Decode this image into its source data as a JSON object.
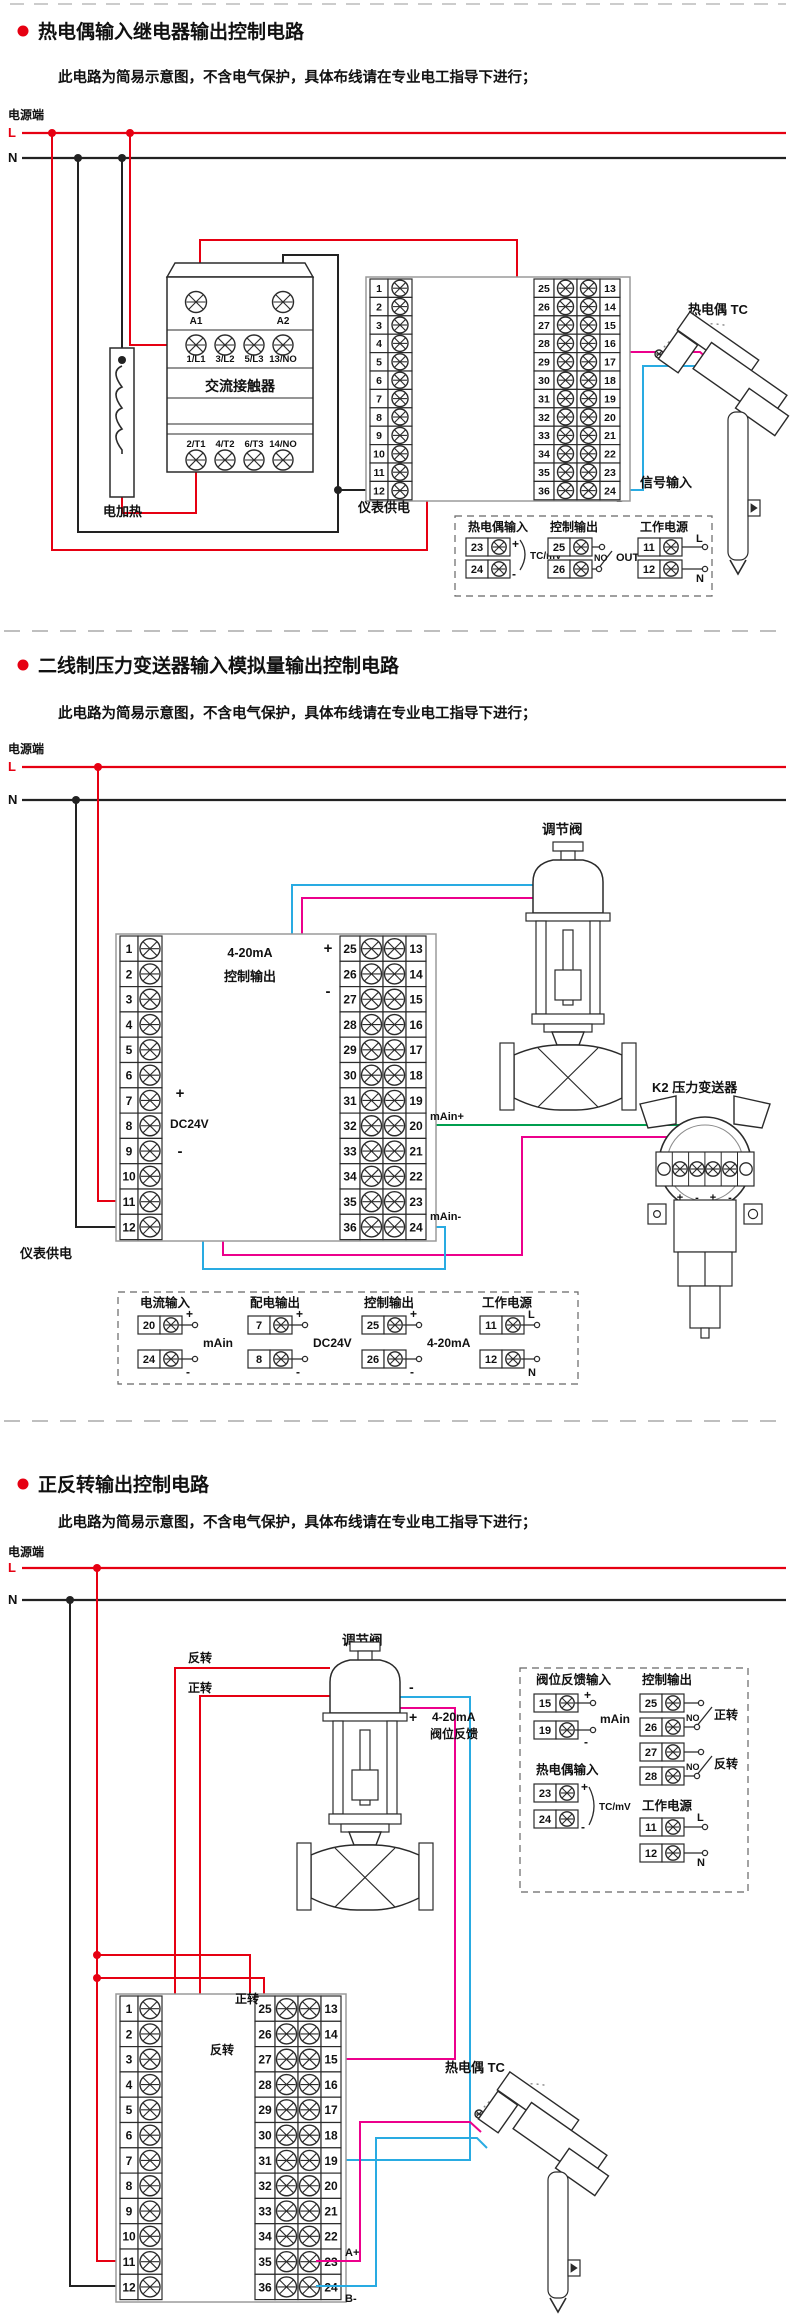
{
  "colors": {
    "red": "#e60012",
    "black": "#222222",
    "gray": "#9a9a9a",
    "pink": "#ec008c",
    "blue": "#29abe2",
    "green": "#009e4f"
  },
  "power": {
    "source": "电源端",
    "l": "L",
    "n": "N"
  },
  "terminals": {
    "left": [
      "1",
      "2",
      "3",
      "4",
      "5",
      "6",
      "7",
      "8",
      "9",
      "10",
      "11",
      "12"
    ],
    "mid": [
      "25",
      "26",
      "27",
      "28",
      "29",
      "30",
      "31",
      "32",
      "33",
      "34",
      "35",
      "36"
    ],
    "right": [
      "13",
      "14",
      "15",
      "16",
      "17",
      "18",
      "19",
      "20",
      "21",
      "22",
      "23",
      "24"
    ]
  },
  "sections": [
    {
      "title": "热电偶输入继电器输出控制电路",
      "subtitle": "此电路为简易示意图，不含电气保护，具体布线请在专业电工指导下进行；",
      "contactor": {
        "name": "交流接触器",
        "coil": [
          "A1",
          "A2"
        ],
        "input": [
          "1/L1",
          "3/L2",
          "5/L3",
          "13/NO"
        ],
        "output": [
          "2/T1",
          "4/T2",
          "6/T3",
          "14/NO"
        ]
      },
      "heater": "电加热",
      "meter_power": "仪表供电",
      "signal_input": "信号输入",
      "a_plus": "A+",
      "b_minus": "B-",
      "tc": "热电偶 TC",
      "detail": {
        "tc_in": {
          "title": "热电偶输入",
          "t1": "23",
          "t2": "24",
          "p": "+",
          "m": "-",
          "tag": "TC/mV"
        },
        "ctrl": {
          "title": "控制输出",
          "t1": "25",
          "t2": "26",
          "no": "NO",
          "out": "OUT"
        },
        "pwr": {
          "title": "工作电源",
          "t1": "11",
          "t2": "12",
          "l": "L",
          "n": "N"
        }
      }
    },
    {
      "title": "二线制压力变送器输入模拟量输出控制电路",
      "subtitle": "此电路为简易示意图，不含电气保护，具体布线请在专业电工指导下进行；",
      "out1": "4-20mA",
      "out2": "控制输出",
      "plus": "+",
      "minus": "-",
      "dc24v": "DC24V",
      "meter_power": "仪表供电",
      "valve": "调节阀",
      "transmitter": "K2 压力变送器",
      "main_plus": "mAin+",
      "main_minus": "mAin-",
      "tx_marks": [
        "+",
        "-",
        "+",
        "-"
      ],
      "tx_a": "A",
      "tx_b": "B",
      "tx_bracket": "A",
      "detail": {
        "cur": {
          "title": "电流输入",
          "t1": "20",
          "t2": "24",
          "p": "+",
          "m": "-",
          "tag": "mAin"
        },
        "dist": {
          "title": "配电输出",
          "t1": "7",
          "t2": "8",
          "p": "+",
          "m": "-",
          "tag": "DC24V"
        },
        "ctrl": {
          "title": "控制输出",
          "t1": "25",
          "t2": "26",
          "p": "+",
          "m": "-",
          "tag": "4-20mA"
        },
        "pwr": {
          "title": "工作电源",
          "t1": "11",
          "t2": "12",
          "l": "L",
          "n": "N"
        }
      }
    },
    {
      "title": "正反转输出控制电路",
      "subtitle": "此电路为简易示意图，不含电气保护，具体布线请在专业电工指导下进行；",
      "valve": "调节阀",
      "reverse": "反转",
      "forward": "正转",
      "minus": "-",
      "plus": "+",
      "fb1": "4-20mA",
      "fb2": "阀位反馈",
      "fwd_block": "正转",
      "rev_block": "反转",
      "a_plus": "A+",
      "b_minus": "B-",
      "tc": "热电偶 TC",
      "detail": {
        "fb": {
          "title": "阀位反馈输入",
          "t1": "15",
          "t2": "19",
          "p": "+",
          "m": "-",
          "tag": "mAin"
        },
        "ctrl": {
          "title": "控制输出",
          "rows": [
            [
              "25",
              "26",
              "NO",
              "正转"
            ],
            [
              "27",
              "28",
              "NO",
              "反转"
            ]
          ]
        },
        "tc_in": {
          "title": "热电偶输入",
          "t1": "23",
          "t2": "24",
          "p": "+",
          "m": "-",
          "tag": "TC/mV"
        },
        "pwr": {
          "title": "工作电源",
          "t1": "11",
          "t2": "12",
          "l": "L",
          "n": "N"
        }
      }
    }
  ]
}
